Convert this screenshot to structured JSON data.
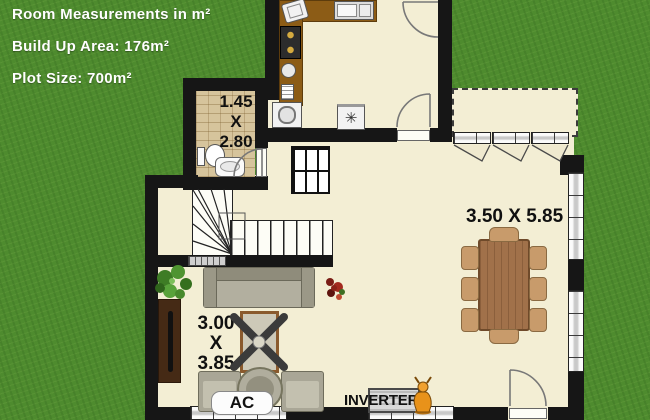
{
  "header": {
    "title": "Room Measurements in m²",
    "build_up_area": "Build Up Area: 176m²",
    "plot_size": "Plot Size: 700m²"
  },
  "rooms": {
    "bathroom": {
      "width": "1.45",
      "separator": "X",
      "length": "2.80"
    },
    "living": {
      "width": "3.00",
      "separator": "X",
      "length": "3.85"
    },
    "dining": {
      "dimensions": "3.50 X 5.85"
    }
  },
  "equipment": {
    "ac_label": "AC",
    "inverter_label": "INVERTER"
  },
  "icons": {
    "fridge_snowflake": "✳"
  },
  "colors": {
    "grass": "#4e8b2e",
    "floor": "#f3eed4",
    "wall": "#161616",
    "counter_wood": "#8c5c16",
    "table_wood": "#a1714a",
    "header_text": "#ffffff",
    "dimension_text": "#101010"
  }
}
